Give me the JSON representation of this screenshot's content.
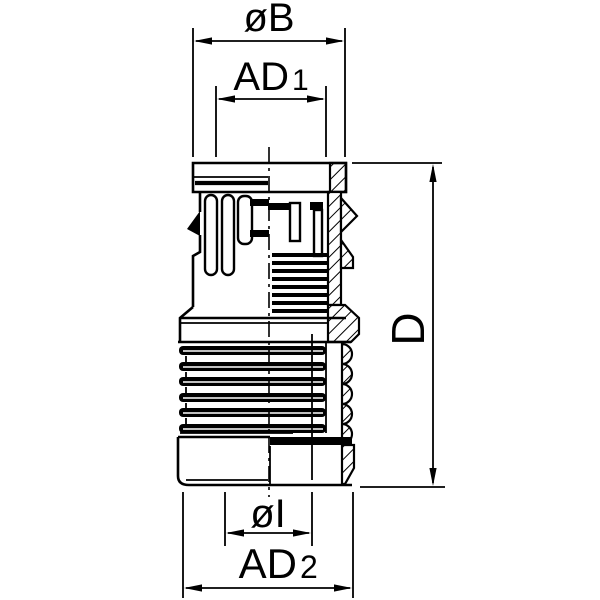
{
  "drawing": {
    "type": "engineering-half-section-drawing",
    "subject": "corrugated-conduit push-in fitting",
    "background_color": "#ffffff",
    "line_color": "#000000"
  },
  "dimension_labels": {
    "outer_diameter_top": {
      "main": "øB",
      "sub": ""
    },
    "inner_diameter_top": {
      "main": "AD",
      "sub": "1"
    },
    "overall_length": {
      "main": "D",
      "sub": ""
    },
    "inner_diameter_bottom": {
      "main": "øI",
      "sub": ""
    },
    "outer_diameter_bottom": {
      "main": "AD",
      "sub": "2"
    }
  }
}
